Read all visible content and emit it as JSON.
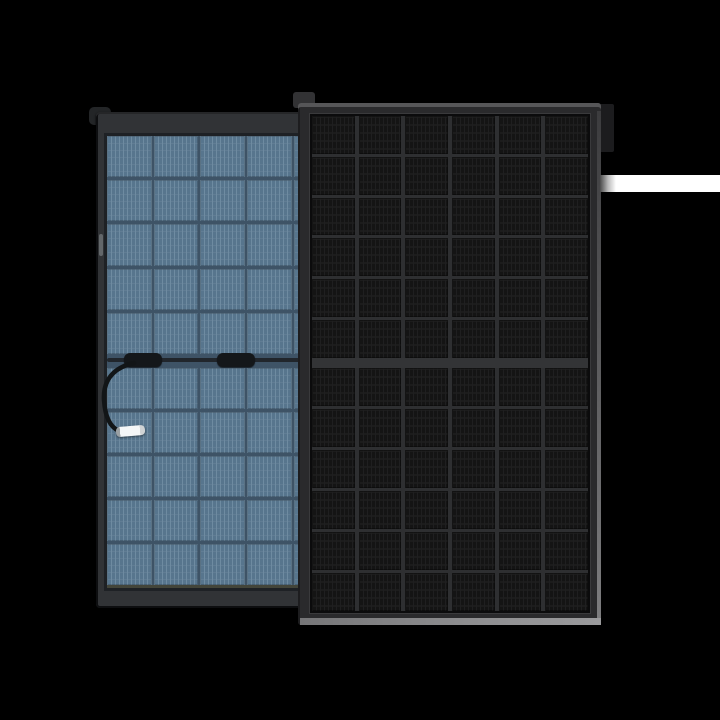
{
  "image": {
    "type": "product-photo",
    "subject": "Two rigid framed solar panels: rear bifacial (blue) view behind left, all-black front view overlapping in front right",
    "background_color": "#000000"
  },
  "rear_panel": {
    "label": "bifacial-solar-panel-rear-view",
    "frame_color": "#313336",
    "frame_notch_color": "#8d9296",
    "cell_color": "#57758d",
    "cell_stripe_color": "#6e8ba1",
    "cell_gap_color": "#3e5366",
    "columns": 6,
    "rows_top": 5,
    "rows_bottom": 5,
    "junction_rail_color": "#21262c",
    "junction_box_color": "#14171a",
    "junction_box_count": 3,
    "cable_color": "#121517",
    "connector_color": "#f4f6f7"
  },
  "front_panel": {
    "label": "all-black-solar-panel-front-view",
    "frame_color": "#2a2a2c",
    "frame_top_edge_color": "#565658",
    "frame_right_edge_color": "#7d7d7f",
    "frame_bottom_edge_color": "#8f8f91",
    "cell_color": "#141414",
    "cell_stripe_color": "#1f1f20",
    "cell_gap_color": "#2e2f31",
    "columns": 6,
    "rows_top": 6,
    "rows_bottom": 6
  },
  "highlight_band": {
    "color": "#ffffff"
  }
}
